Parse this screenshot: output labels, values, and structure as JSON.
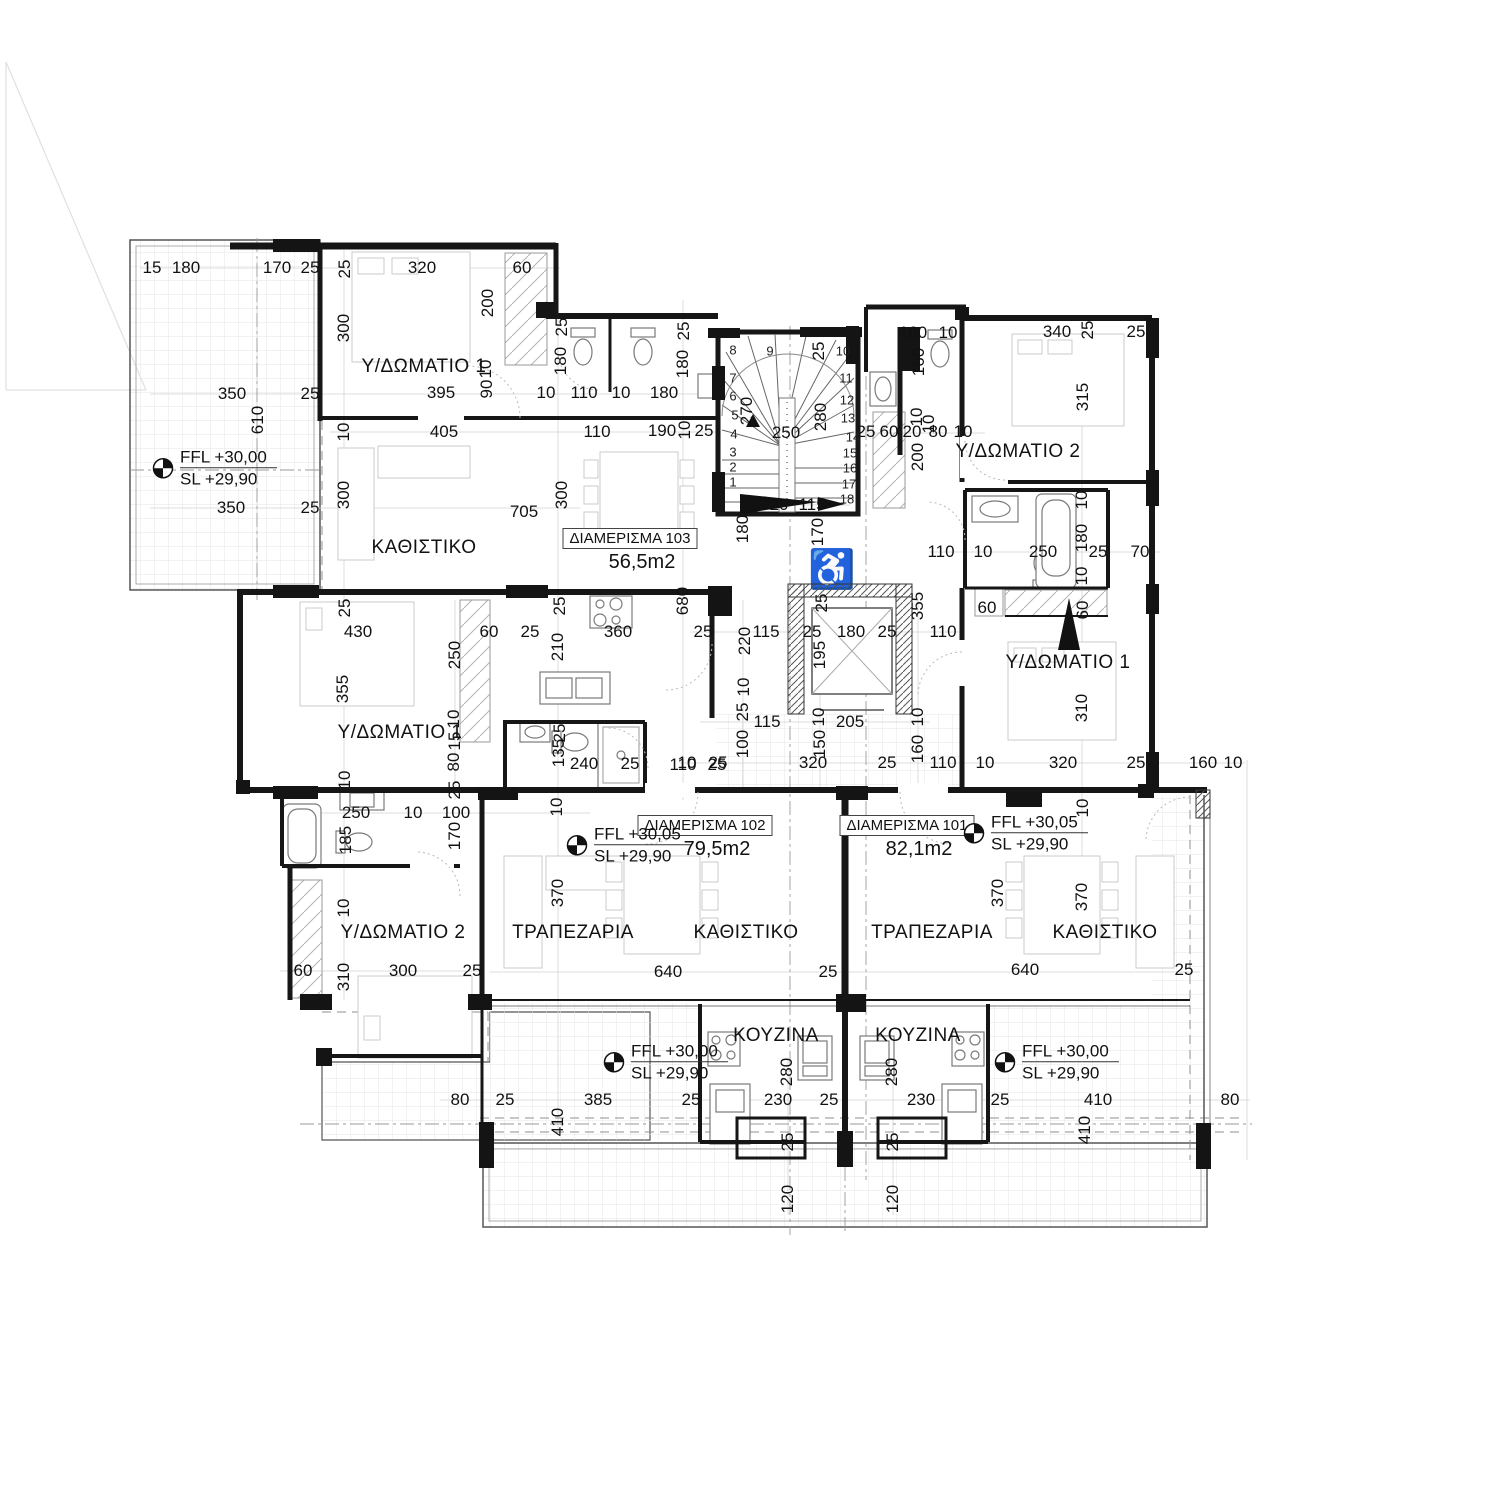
{
  "drawing_title": "Floor plan level +30,00",
  "room_labels": [
    {
      "t": "Υ/ΔΩΜΑΤΙΟ 1",
      "x": 424,
      "y": 367
    },
    {
      "t": "ΚΑΘΙΣΤΙΚΟ",
      "x": 424,
      "y": 548
    },
    {
      "t": "Υ/ΔΩΜΑΤΙΟ 2",
      "x": 1018,
      "y": 452
    },
    {
      "t": "Υ/ΔΩΜΑΤΙΟ 1",
      "x": 1068,
      "y": 663
    },
    {
      "t": "Υ/ΔΩΜΑΤΙΟ 1",
      "x": 400,
      "y": 733
    },
    {
      "t": "Υ/ΔΩΜΑΤΙΟ 2",
      "x": 403,
      "y": 933
    },
    {
      "t": "ΤΡΑΠΕΖΑΡΙΑ",
      "x": 573,
      "y": 933
    },
    {
      "t": "ΚΑΘΙΣΤΙΚΟ",
      "x": 746,
      "y": 933
    },
    {
      "t": "ΤΡΑΠΕΖΑΡΙΑ",
      "x": 932,
      "y": 933
    },
    {
      "t": "ΚΑΘΙΣΤΙΚΟ",
      "x": 1105,
      "y": 933
    },
    {
      "t": "ΚΟΥΖΙΝΑ",
      "x": 776,
      "y": 1036
    },
    {
      "t": "ΚΟΥΖΙΝΑ",
      "x": 918,
      "y": 1036
    }
  ],
  "apartment_tags": [
    {
      "name": "ΔΙΑΜΕΡΙΣΜΑ 103",
      "area": "56,5m2",
      "x": 630,
      "y": 540
    },
    {
      "name": "ΔΙΑΜΕΡΙΣΜΑ 102",
      "area": "79,5m2",
      "x": 705,
      "y": 827
    },
    {
      "name": "ΔΙΑΜΕΡΙΣΜΑ 101",
      "area": "82,1m2",
      "x": 907,
      "y": 827
    }
  ],
  "level_markers": [
    {
      "ffl": "FFL +30,00",
      "sl": "SL   +29,90",
      "x": 152,
      "y": 468
    },
    {
      "ffl": "FFL +30,05",
      "sl": "SL   +29,90",
      "x": 566,
      "y": 845
    },
    {
      "ffl": "FFL +30,05",
      "sl": "SL   +29,90",
      "x": 963,
      "y": 833
    },
    {
      "ffl": "FFL +30,00",
      "sl": "SL   +29,90",
      "x": 603,
      "y": 1062
    },
    {
      "ffl": "FFL +30,00",
      "sl": "SL   +29,90",
      "x": 994,
      "y": 1062
    }
  ],
  "stair_numbers": [
    [
      "1",
      733,
      482
    ],
    [
      "2",
      733,
      467
    ],
    [
      "3",
      733,
      452
    ],
    [
      "4",
      734,
      434
    ],
    [
      "5",
      735,
      415
    ],
    [
      "6",
      733,
      396
    ],
    [
      "7",
      733,
      378
    ],
    [
      "8",
      733,
      350
    ],
    [
      "9",
      770,
      351
    ],
    [
      "10",
      843,
      351
    ],
    [
      "11",
      846,
      378
    ],
    [
      "12",
      847,
      400
    ],
    [
      "13",
      848,
      418
    ],
    [
      "14",
      853,
      437
    ],
    [
      "15",
      850,
      453
    ],
    [
      "16",
      850,
      468
    ],
    [
      "17",
      849,
      484
    ],
    [
      "18",
      847,
      499
    ]
  ],
  "dims": [
    [
      "15",
      152,
      268,
      0
    ],
    [
      "180",
      186,
      268,
      0
    ],
    [
      "170",
      277,
      268,
      0
    ],
    [
      "25",
      310,
      268,
      0
    ],
    [
      "25",
      345,
      269,
      1
    ],
    [
      "320",
      422,
      268,
      0
    ],
    [
      "60",
      522,
      268,
      0
    ],
    [
      "300",
      344,
      328,
      1
    ],
    [
      "200",
      488,
      303,
      1
    ],
    [
      "10",
      486,
      369,
      1
    ],
    [
      "90",
      487,
      389,
      1
    ],
    [
      "395",
      441,
      393,
      0
    ],
    [
      "10",
      546,
      393,
      0
    ],
    [
      "110",
      584,
      393,
      0
    ],
    [
      "10",
      621,
      393,
      0
    ],
    [
      "180",
      664,
      393,
      0
    ],
    [
      "350",
      232,
      394,
      0
    ],
    [
      "25",
      310,
      394,
      0
    ],
    [
      "610",
      258,
      420,
      1
    ],
    [
      "10",
      344,
      432,
      1
    ],
    [
      "405",
      444,
      432,
      0
    ],
    [
      "110",
      597,
      432,
      0
    ],
    [
      "190",
      662,
      431,
      0
    ],
    [
      "10",
      685,
      430,
      1
    ],
    [
      "25",
      704,
      431,
      0
    ],
    [
      "350",
      231,
      508,
      0
    ],
    [
      "25",
      310,
      508,
      0
    ],
    [
      "300",
      344,
      495,
      1
    ],
    [
      "705",
      524,
      512,
      0
    ],
    [
      "300",
      562,
      495,
      1
    ],
    [
      "25",
      562,
      327,
      1
    ],
    [
      "180",
      561,
      361,
      1
    ],
    [
      "25",
      684,
      331,
      1
    ],
    [
      "180",
      683,
      364,
      1
    ],
    [
      "25",
      819,
      351,
      1
    ],
    [
      "270",
      747,
      411,
      1
    ],
    [
      "280",
      821,
      417,
      1
    ],
    [
      "250",
      786,
      433,
      0
    ],
    [
      "115",
      754,
      503,
      0
    ],
    [
      "20",
      779,
      505,
      0
    ],
    [
      "115",
      812,
      505,
      0
    ],
    [
      "180",
      743,
      529,
      1
    ],
    [
      "170",
      818,
      532,
      1
    ],
    [
      "160",
      913,
      333,
      0
    ],
    [
      "10",
      948,
      333,
      0
    ],
    [
      "340",
      1057,
      332,
      0
    ],
    [
      "25",
      1088,
      330,
      1
    ],
    [
      "25",
      1136,
      332,
      0
    ],
    [
      "160",
      919,
      362,
      1
    ],
    [
      "10",
      917,
      417,
      1
    ],
    [
      "315",
      1083,
      397,
      1
    ],
    [
      "25",
      866,
      432,
      0
    ],
    [
      "60",
      889,
      432,
      0
    ],
    [
      "20",
      912,
      432,
      0
    ],
    [
      "10",
      929,
      424,
      1
    ],
    [
      "80",
      938,
      432,
      0
    ],
    [
      "10",
      963,
      432,
      0
    ],
    [
      "200",
      918,
      457,
      1
    ],
    [
      "110",
      941,
      552,
      0
    ],
    [
      "10",
      983,
      552,
      0
    ],
    [
      "250",
      1043,
      552,
      0
    ],
    [
      "180",
      1082,
      538,
      1
    ],
    [
      "25",
      1098,
      552,
      0
    ],
    [
      "70",
      1140,
      552,
      0
    ],
    [
      "10",
      1082,
      500,
      1
    ],
    [
      "10",
      1082,
      576,
      1
    ],
    [
      "60",
      987,
      608,
      0
    ],
    [
      "60",
      1083,
      610,
      1
    ],
    [
      "680",
      683,
      601,
      1
    ],
    [
      "25",
      703,
      632,
      0
    ],
    [
      "115",
      766,
      632,
      0
    ],
    [
      "25",
      812,
      632,
      0
    ],
    [
      "180",
      851,
      632,
      0
    ],
    [
      "25",
      887,
      632,
      0
    ],
    [
      "110",
      943,
      632,
      0
    ],
    [
      "220",
      745,
      641,
      1
    ],
    [
      "25",
      822,
      603,
      1
    ],
    [
      "195",
      820,
      655,
      1
    ],
    [
      "355",
      918,
      606,
      1
    ],
    [
      "10",
      744,
      687,
      1
    ],
    [
      "25",
      743,
      712,
      1
    ],
    [
      "115",
      767,
      722,
      0
    ],
    [
      "10",
      819,
      717,
      1
    ],
    [
      "205",
      850,
      722,
      0
    ],
    [
      "10",
      918,
      717,
      1
    ],
    [
      "100",
      743,
      744,
      1
    ],
    [
      "150",
      820,
      744,
      1
    ],
    [
      "10",
      687,
      763,
      0
    ],
    [
      "25",
      718,
      763,
      0
    ],
    [
      "320",
      813,
      763,
      0
    ],
    [
      "25",
      887,
      763,
      0
    ],
    [
      "110",
      943,
      763,
      0
    ],
    [
      "160",
      918,
      749,
      1
    ],
    [
      "310",
      1082,
      708,
      1
    ],
    [
      "10",
      985,
      763,
      0
    ],
    [
      "320",
      1063,
      763,
      0
    ],
    [
      "25",
      1136,
      763,
      0
    ],
    [
      "160",
      1203,
      763,
      0
    ],
    [
      "10",
      1233,
      763,
      0
    ],
    [
      "10",
      1083,
      808,
      1
    ],
    [
      "25",
      345,
      608,
      1
    ],
    [
      "430",
      358,
      632,
      0
    ],
    [
      "60",
      489,
      632,
      0
    ],
    [
      "25",
      530,
      632,
      0
    ],
    [
      "25",
      560,
      606,
      1
    ],
    [
      "360",
      618,
      632,
      0
    ],
    [
      "250",
      455,
      655,
      1
    ],
    [
      "210",
      558,
      647,
      1
    ],
    [
      "355",
      343,
      689,
      1
    ],
    [
      "10",
      454,
      719,
      1
    ],
    [
      "15",
      455,
      741,
      1
    ],
    [
      "80",
      454,
      762,
      1
    ],
    [
      "25",
      560,
      733,
      1
    ],
    [
      "135",
      559,
      753,
      1
    ],
    [
      "240",
      584,
      764,
      0
    ],
    [
      "25",
      630,
      764,
      0
    ],
    [
      "110",
      683,
      765,
      0
    ],
    [
      "25",
      717,
      765,
      0
    ],
    [
      "10",
      557,
      807,
      1
    ],
    [
      "10",
      345,
      780,
      1
    ],
    [
      "25",
      455,
      790,
      1
    ],
    [
      "250",
      356,
      813,
      0
    ],
    [
      "10",
      413,
      813,
      0
    ],
    [
      "100",
      456,
      813,
      0
    ],
    [
      "185",
      346,
      840,
      1
    ],
    [
      "170",
      455,
      836,
      1
    ],
    [
      "10",
      344,
      908,
      1
    ],
    [
      "60",
      303,
      971,
      0
    ],
    [
      "310",
      344,
      977,
      1
    ],
    [
      "300",
      403,
      971,
      0
    ],
    [
      "25",
      472,
      971,
      0
    ],
    [
      "370",
      558,
      893,
      1
    ],
    [
      "640",
      668,
      972,
      0
    ],
    [
      "25",
      828,
      972,
      0
    ],
    [
      "370",
      998,
      893,
      1
    ],
    [
      "370",
      1082,
      897,
      1
    ],
    [
      "640",
      1025,
      970,
      0
    ],
    [
      "25",
      1184,
      970,
      0
    ],
    [
      "385",
      598,
      1100,
      0
    ],
    [
      "25",
      691,
      1100,
      0
    ],
    [
      "230",
      778,
      1100,
      0
    ],
    [
      "25",
      829,
      1100,
      0
    ],
    [
      "280",
      787,
      1072,
      1
    ],
    [
      "25",
      788,
      1142,
      1
    ],
    [
      "230",
      921,
      1100,
      0
    ],
    [
      "25",
      1000,
      1100,
      0
    ],
    [
      "280",
      892,
      1072,
      1
    ],
    [
      "25",
      893,
      1142,
      1
    ],
    [
      "120",
      788,
      1199,
      1
    ],
    [
      "120",
      893,
      1199,
      1
    ],
    [
      "80",
      460,
      1100,
      0
    ],
    [
      "25",
      505,
      1100,
      0
    ],
    [
      "410",
      558,
      1122,
      1
    ],
    [
      "410",
      1098,
      1100,
      0
    ],
    [
      "410",
      1085,
      1130,
      1
    ],
    [
      "80",
      1230,
      1100,
      0
    ]
  ],
  "colors": {
    "wall": "#161616",
    "thin": "#666666",
    "light": "#cccccc",
    "grid": "#e3e3e3"
  }
}
